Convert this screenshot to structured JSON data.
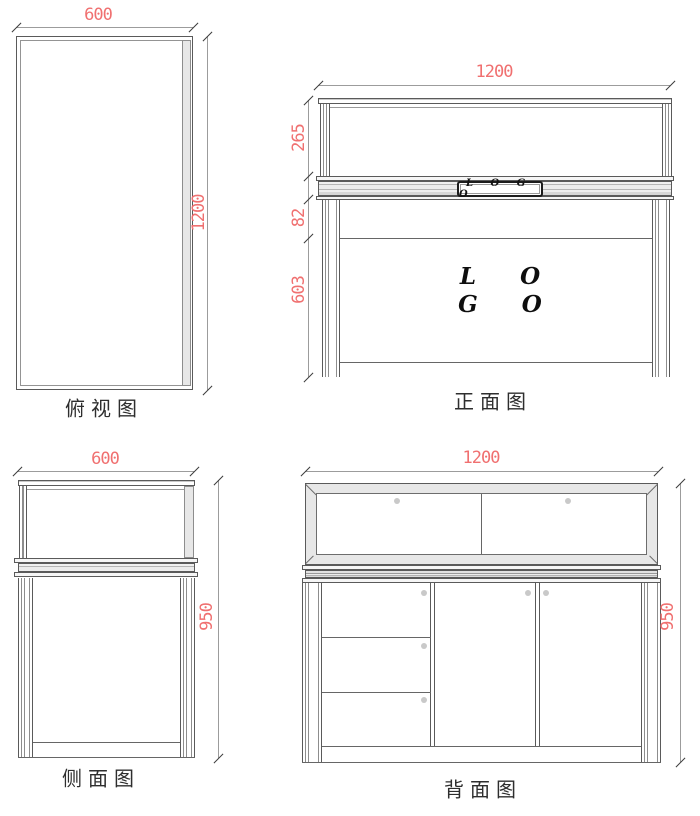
{
  "drawing_title": "display-counter-orthographic-drawing",
  "colors": {
    "dimension_text": "#f07070",
    "outline": "#5a5a5a",
    "frame_fill": "#e7e7e7",
    "knob": "#c9c9c9"
  },
  "views": {
    "top": {
      "caption": "俯视图",
      "dim_width": "600",
      "dim_depth": "1200"
    },
    "front": {
      "caption": "正面图",
      "dim_width": "1200",
      "dim_glass_height": "265",
      "dim_apron_height": "82",
      "dim_body_height": "603",
      "plate_text": "L O G O",
      "logo_line1": "L O",
      "logo_line2": "G O"
    },
    "side": {
      "caption": "侧面图",
      "dim_width": "600",
      "dim_height": "950"
    },
    "back": {
      "caption": "背面图",
      "dim_width": "1200",
      "dim_height": "950"
    }
  }
}
